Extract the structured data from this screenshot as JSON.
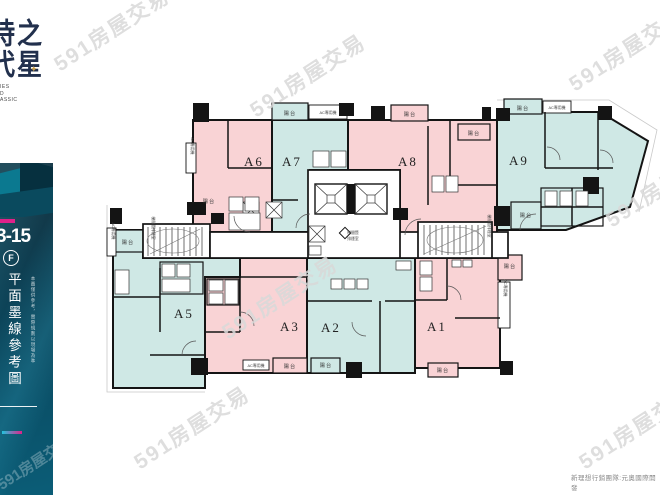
{
  "branding": {
    "logo_top": "時代",
    "logo_bottom": "之星",
    "star": "✦",
    "sub_fragments": [
      "IES",
      "D",
      "ASSIC"
    ]
  },
  "sidebar": {
    "floor_range": "3-15",
    "badge": "F",
    "title_vertical": "平面墨線參考圖",
    "disclaimer_vertical": "本圖僅供參考，實際規劃以現場為準"
  },
  "plan": {
    "units": [
      {
        "id": "A1",
        "tone": "pink"
      },
      {
        "id": "A2",
        "tone": "teal"
      },
      {
        "id": "A3",
        "tone": "pink"
      },
      {
        "id": "A5",
        "tone": "teal"
      },
      {
        "id": "A6",
        "tone": "pink"
      },
      {
        "id": "A7",
        "tone": "teal"
      },
      {
        "id": "A8",
        "tone": "pink"
      },
      {
        "id": "A9",
        "tone": "teal"
      }
    ],
    "labels": {
      "balcony": "陽台",
      "ac_unit": "AC專用機",
      "lobby_1": "梯間暨",
      "lobby_2": "排煙室",
      "stair_room": "梯間暨排煙室"
    }
  },
  "watermark": {
    "text": "591房屋交易"
  },
  "footer": {
    "credit": "新理想行銷團隊:元奧國際開發"
  },
  "colors": {
    "pink": "#f9d3d5",
    "teal": "#cfe8e5",
    "wall": "#141414",
    "panel": "#0d4258",
    "accent_pink": "#e0218a",
    "accent_cyan": "#22c3dd",
    "watermark": "#d9d9d9"
  }
}
